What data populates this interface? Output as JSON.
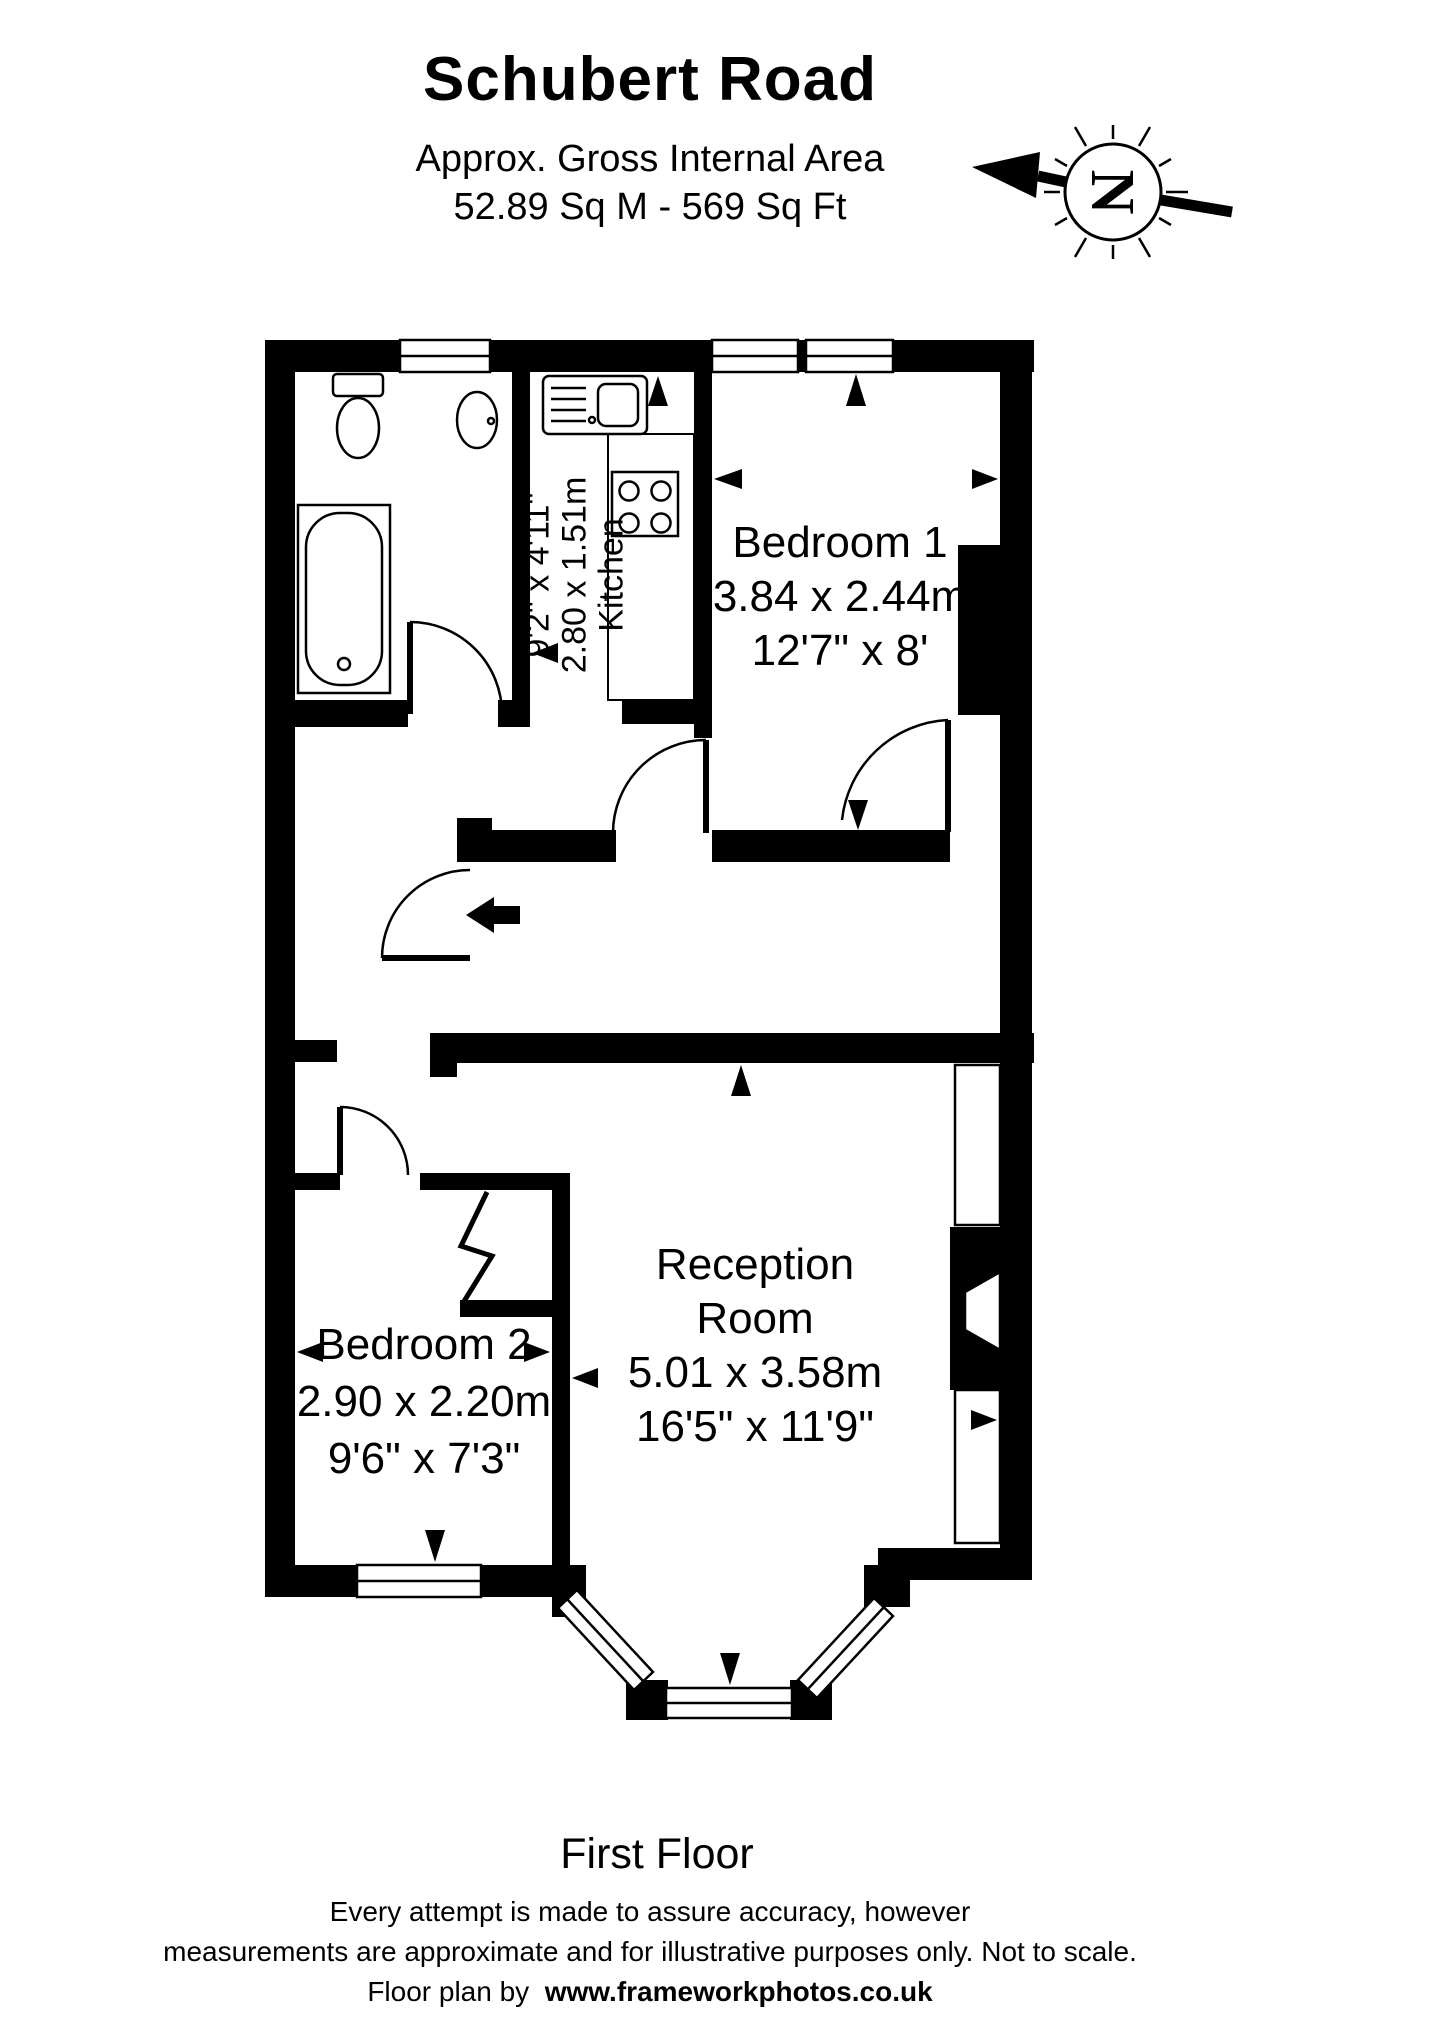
{
  "page": {
    "background_color": "#ffffff",
    "ink_color": "#000000"
  },
  "header": {
    "title": "Schubert Road",
    "subtitle_line1": "Approx. Gross Internal Area",
    "subtitle_line2": "52.89 Sq M  -  569 Sq Ft"
  },
  "compass": {
    "letter": "N"
  },
  "plan": {
    "floor_label": "First Floor",
    "rooms": [
      {
        "key": "bedroom-1",
        "name": "Bedroom 1",
        "dims_metric": "3.84 x 2.44m",
        "dims_imperial": "12'7\" x 8'"
      },
      {
        "key": "kitchen",
        "name": "Kitchen",
        "dims_metric": "2.80 x 1.51m",
        "dims_imperial": "9'2\" x 4'11\""
      },
      {
        "key": "bedroom-2",
        "name": "Bedroom 2",
        "dims_metric": "2.90 x 2.20m",
        "dims_imperial": "9'6\" x 7'3\""
      },
      {
        "key": "reception-room",
        "name_line1": "Reception",
        "name_line2": "Room",
        "dims_metric": "5.01 x 3.58m",
        "dims_imperial": "16'5\" x 11'9\""
      }
    ],
    "fixtures": [
      "toilet",
      "bath",
      "basin",
      "kitchen-sink",
      "hob"
    ]
  },
  "footer": {
    "line1": "Every attempt is made to assure accuracy, however",
    "line2": "measurements are approximate and for illustrative purposes only. Not to scale.",
    "line3_prefix": "Floor plan by",
    "line3_url": "www.frameworkphotos.co.uk"
  }
}
